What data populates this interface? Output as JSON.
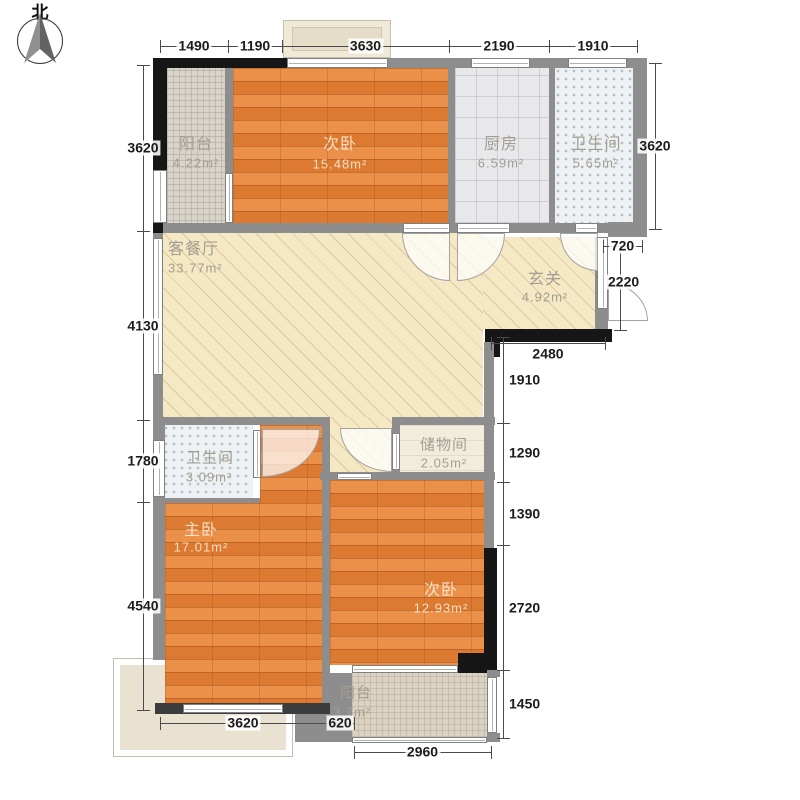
{
  "compass": {
    "north": "北"
  },
  "elements": [
    {
      "n": "patio-terrace",
      "c": "el patio",
      "x": 113,
      "y": 658,
      "w": 180,
      "h": 99
    },
    {
      "n": "bay-window",
      "c": "el bay",
      "x": 283,
      "y": 20,
      "w": 108,
      "h": 38
    },
    {
      "n": "bay-window-inner",
      "c": "el bayin",
      "x": 292,
      "y": 27,
      "w": 90,
      "h": 24
    },
    {
      "n": "balcony-north-floor",
      "c": "el mosaic",
      "x": 167,
      "y": 68,
      "w": 58,
      "h": 165
    },
    {
      "n": "bedroom-north-floor",
      "c": "el wood",
      "x": 233,
      "y": 68,
      "w": 215,
      "h": 155
    },
    {
      "n": "kitchen-floor",
      "c": "el ktile",
      "x": 455,
      "y": 68,
      "w": 94,
      "h": 155
    },
    {
      "n": "bathroom-north-floor",
      "c": "el dots",
      "x": 555,
      "y": 68,
      "w": 78,
      "h": 155
    },
    {
      "n": "living-dining-floor",
      "c": "el hatch",
      "x": 163,
      "y": 233,
      "w": 320,
      "h": 184
    },
    {
      "n": "entry-floor",
      "c": "el hatch",
      "x": 483,
      "y": 237,
      "w": 112,
      "h": 92
    },
    {
      "n": "corridor-floor",
      "c": "el hatch",
      "x": 330,
      "y": 417,
      "w": 62,
      "h": 55
    },
    {
      "n": "storage-floor",
      "c": "el cream",
      "x": 400,
      "y": 425,
      "w": 87,
      "h": 47
    },
    {
      "n": "bathroom-south-floor",
      "c": "el dots",
      "x": 163,
      "y": 425,
      "w": 90,
      "h": 73
    },
    {
      "n": "vestibule-floor",
      "c": "el wood",
      "x": 260,
      "y": 425,
      "w": 62,
      "h": 78
    },
    {
      "n": "master-bedroom-floor",
      "c": "el wood",
      "x": 165,
      "y": 503,
      "w": 157,
      "h": 200
    },
    {
      "n": "bedroom-south-floor",
      "c": "el wood",
      "x": 330,
      "y": 480,
      "w": 154,
      "h": 185
    },
    {
      "n": "balcony-south-floor",
      "c": "el mosaic2",
      "x": 352,
      "y": 673,
      "w": 135,
      "h": 64
    },
    {
      "n": "top-wall-left",
      "c": "el wallb",
      "x": 153,
      "y": 58,
      "w": 134,
      "h": 10
    },
    {
      "n": "top-wall-right",
      "c": "el wall",
      "x": 388,
      "y": 58,
      "w": 259,
      "h": 10
    },
    {
      "n": "left-wall-upper",
      "c": "el wallb",
      "x": 153,
      "y": 68,
      "w": 14,
      "h": 102
    },
    {
      "n": "left-wall-upper-corner",
      "c": "el wallb",
      "x": 153,
      "y": 223,
      "w": 14,
      "h": 10
    },
    {
      "n": "balcony-partition-wall",
      "c": "el wall",
      "x": 225,
      "y": 68,
      "w": 8,
      "h": 105
    },
    {
      "n": "bedroom-kitchen-wall",
      "c": "el wall",
      "x": 448,
      "y": 68,
      "w": 7,
      "h": 155
    },
    {
      "n": "kitchen-bath-wall",
      "c": "el wall",
      "x": 549,
      "y": 68,
      "w": 6,
      "h": 155
    },
    {
      "n": "right-outer-wall",
      "c": "el wall",
      "x": 633,
      "y": 58,
      "w": 14,
      "h": 179
    },
    {
      "n": "band-bottom-wall-a",
      "c": "el wall",
      "x": 163,
      "y": 223,
      "w": 240,
      "h": 10
    },
    {
      "n": "band-bottom-wall-b",
      "c": "el wall",
      "x": 450,
      "y": 223,
      "w": 7,
      "h": 10
    },
    {
      "n": "band-bottom-wall-c",
      "c": "el wall",
      "x": 510,
      "y": 223,
      "w": 65,
      "h": 10
    },
    {
      "n": "band-bottom-wall-d",
      "c": "el wall",
      "x": 598,
      "y": 223,
      "w": 10,
      "h": 10
    },
    {
      "n": "step-wall",
      "c": "el wall",
      "x": 608,
      "y": 222,
      "w": 39,
      "h": 15
    },
    {
      "n": "entry-right-wall",
      "c": "el wall",
      "x": 595,
      "y": 237,
      "w": 13,
      "h": 92
    },
    {
      "n": "entry-black-wall",
      "c": "el wallb",
      "x": 485,
      "y": 329,
      "w": 127,
      "h": 13
    },
    {
      "n": "entry-corner-black",
      "c": "el wallb",
      "x": 487,
      "y": 342,
      "w": 13,
      "h": 15
    },
    {
      "n": "right-mid-wall",
      "c": "el wall",
      "x": 484,
      "y": 342,
      "w": 10,
      "h": 206
    },
    {
      "n": "bedroom-south-right-wall",
      "c": "el wallb",
      "x": 484,
      "y": 548,
      "w": 13,
      "h": 125
    },
    {
      "n": "mid-wall-west",
      "c": "el wall",
      "x": 163,
      "y": 417,
      "w": 167,
      "h": 8
    },
    {
      "n": "mid-wall-east",
      "c": "el wall",
      "x": 392,
      "y": 417,
      "w": 103,
      "h": 8
    },
    {
      "n": "storage-left-wall",
      "c": "el wall",
      "x": 392,
      "y": 425,
      "w": 8,
      "h": 55
    },
    {
      "n": "storage-bottom-wall",
      "c": "el wall",
      "x": 392,
      "y": 472,
      "w": 103,
      "h": 8
    },
    {
      "n": "corridor-bottom-wall",
      "c": "el wall",
      "x": 320,
      "y": 472,
      "w": 72,
      "h": 8
    },
    {
      "n": "vestibule-right-wall",
      "c": "el wall",
      "x": 322,
      "y": 425,
      "w": 8,
      "h": 55
    },
    {
      "n": "bathroom-south-bottom-wall",
      "c": "el wall",
      "x": 163,
      "y": 498,
      "w": 97,
      "h": 5
    },
    {
      "n": "bedroom-divider-wall",
      "c": "el wall",
      "x": 322,
      "y": 480,
      "w": 8,
      "h": 223
    },
    {
      "n": "balcony-south-left-wall",
      "c": "el wall",
      "x": 330,
      "y": 673,
      "w": 22,
      "h": 69
    },
    {
      "n": "master-bottom-side-wall",
      "c": "el wall",
      "x": 295,
      "y": 703,
      "w": 35,
      "h": 39
    },
    {
      "n": "master-bottom-wall",
      "c": "el walld",
      "x": 155,
      "y": 703,
      "w": 175,
      "h": 11
    },
    {
      "n": "balcony-corner-black",
      "c": "el wallb",
      "x": 458,
      "y": 653,
      "w": 39,
      "h": 20
    },
    {
      "n": "balcony-corner-sq1",
      "c": "el wall",
      "x": 487,
      "y": 670,
      "w": 13,
      "h": 7
    },
    {
      "n": "balcony-corner-sq2",
      "c": "el wall",
      "x": 487,
      "y": 733,
      "w": 13,
      "h": 9
    },
    {
      "n": "left-wall-mid",
      "c": "el wall",
      "x": 153,
      "y": 233,
      "w": 10,
      "h": 187
    },
    {
      "n": "left-wall-low1",
      "c": "el wall",
      "x": 153,
      "y": 420,
      "w": 12,
      "h": 80
    },
    {
      "n": "left-wall-low2",
      "c": "el wall",
      "x": 153,
      "y": 500,
      "w": 12,
      "h": 160
    },
    {
      "n": "bay-base-window",
      "c": "el win wh",
      "x": 287,
      "y": 58,
      "w": 101,
      "h": 10
    },
    {
      "n": "balcony-left-window",
      "c": "el win wv",
      "x": 153,
      "y": 170,
      "w": 14,
      "h": 53
    },
    {
      "n": "partition-window",
      "c": "el win wv",
      "x": 225,
      "y": 173,
      "w": 8,
      "h": 50
    },
    {
      "n": "kitchen-top-window",
      "c": "el win wh",
      "x": 471,
      "y": 58,
      "w": 59,
      "h": 10
    },
    {
      "n": "bath-north-top-window",
      "c": "el win wh",
      "x": 568,
      "y": 58,
      "w": 59,
      "h": 10
    },
    {
      "n": "living-left-window",
      "c": "el win wv",
      "x": 153,
      "y": 238,
      "w": 10,
      "h": 137
    },
    {
      "n": "bath-south-left-window",
      "c": "el win wv",
      "x": 153,
      "y": 440,
      "w": 12,
      "h": 57
    },
    {
      "n": "entry-right-window",
      "c": "el win wv",
      "x": 597,
      "y": 237,
      "w": 11,
      "h": 72
    },
    {
      "n": "bedroom-balcony-window",
      "c": "el win wh",
      "x": 352,
      "y": 665,
      "w": 106,
      "h": 8
    },
    {
      "n": "balcony-right-rail",
      "c": "el win wv",
      "x": 487,
      "y": 677,
      "w": 10,
      "h": 56
    },
    {
      "n": "balcony-bottom-rail",
      "c": "el win wh",
      "x": 352,
      "y": 737,
      "w": 135,
      "h": 6
    },
    {
      "n": "master-bottom-window",
      "c": "el win wh",
      "x": 183,
      "y": 704,
      "w": 100,
      "h": 9
    },
    {
      "n": "storage-door-jamb",
      "c": "el win wv",
      "x": 392,
      "y": 433,
      "w": 8,
      "h": 37
    },
    {
      "n": "bath-south-door-jamb",
      "c": "el win wv",
      "x": 253,
      "y": 430,
      "w": 8,
      "h": 48
    },
    {
      "n": "corridor-bedroom-opening",
      "c": "el win wh",
      "x": 337,
      "y": 473,
      "w": 35,
      "h": 7
    },
    {
      "n": "bedroom-north-door-opening",
      "c": "el win wh",
      "x": 403,
      "y": 223,
      "w": 47,
      "h": 10
    },
    {
      "n": "kitchen-door-opening",
      "c": "el win wh",
      "x": 457,
      "y": 223,
      "w": 53,
      "h": 10
    },
    {
      "n": "bath-north-door-opening",
      "c": "el win wh",
      "x": 575,
      "y": 223,
      "w": 23,
      "h": 10
    },
    {
      "n": "bedroom-north-door",
      "c": "el door c-bl",
      "x": 402,
      "y": 233,
      "w": 48,
      "h": 48
    },
    {
      "n": "kitchen-door",
      "c": "el door c-br",
      "x": 457,
      "y": 233,
      "w": 48,
      "h": 48
    },
    {
      "n": "bath-north-door",
      "c": "el door c-bl",
      "x": 560,
      "y": 233,
      "w": 38,
      "h": 38
    },
    {
      "n": "entry-door",
      "c": "el door c-tr",
      "x": 608,
      "y": 283,
      "w": 40,
      "h": 38
    },
    {
      "n": "bath-south-door",
      "c": "el door c-br",
      "x": 262,
      "y": 429,
      "w": 58,
      "h": 48
    },
    {
      "n": "storage-door",
      "c": "el door c-bl",
      "x": 340,
      "y": 428,
      "w": 52,
      "h": 44
    }
  ],
  "dims": [
    {
      "o": "h",
      "x": 160,
      "y": 46,
      "l": 68,
      "t": "1490"
    },
    {
      "o": "h",
      "x": 228,
      "y": 46,
      "l": 54,
      "t": "1190"
    },
    {
      "o": "h",
      "x": 282,
      "y": 46,
      "l": 167,
      "t": "3630"
    },
    {
      "o": "h",
      "x": 449,
      "y": 46,
      "l": 100,
      "t": "2190"
    },
    {
      "o": "h",
      "x": 549,
      "y": 46,
      "l": 88,
      "t": "1910"
    },
    {
      "o": "v",
      "x": 143,
      "y": 65,
      "l": 166,
      "t": "3620"
    },
    {
      "o": "v",
      "x": 143,
      "y": 231,
      "l": 189,
      "t": "4130"
    },
    {
      "o": "v",
      "x": 143,
      "y": 420,
      "l": 82,
      "t": "1780"
    },
    {
      "o": "v",
      "x": 143,
      "y": 502,
      "l": 208,
      "t": "4540"
    },
    {
      "o": "v",
      "x": 655,
      "y": 63,
      "l": 166,
      "t": "3620"
    },
    {
      "o": "h",
      "x": 603,
      "y": 246,
      "l": 39,
      "t": "720"
    },
    {
      "o": "v",
      "x": 620,
      "y": 246,
      "l": 84,
      "t": "2220",
      "la": "l",
      "lx": 606,
      "ly": 282
    },
    {
      "o": "h",
      "x": 491,
      "y": 343,
      "l": 114,
      "t": "2480",
      "ly": 354
    },
    {
      "o": "v",
      "x": 503,
      "y": 337,
      "l": 86,
      "t": "1910",
      "la": "l",
      "lx": 507
    },
    {
      "o": "v",
      "x": 503,
      "y": 423,
      "l": 59,
      "t": "1290",
      "la": "l",
      "lx": 507
    },
    {
      "o": "v",
      "x": 503,
      "y": 482,
      "l": 63,
      "t": "1390",
      "la": "l",
      "lx": 507
    },
    {
      "o": "v",
      "x": 503,
      "y": 545,
      "l": 125,
      "t": "2720",
      "la": "l",
      "lx": 507
    },
    {
      "o": "v",
      "x": 503,
      "y": 670,
      "l": 68,
      "t": "1450",
      "la": "l",
      "lx": 507
    },
    {
      "o": "h",
      "x": 160,
      "y": 723,
      "l": 166,
      "t": "3620"
    },
    {
      "o": "h",
      "x": 326,
      "y": 723,
      "l": 28,
      "t": "620"
    },
    {
      "o": "h",
      "x": 354,
      "y": 752,
      "l": 137,
      "t": "2960"
    }
  ],
  "labels": [
    {
      "n": "room-label-balcony-north",
      "t": "阳台",
      "x": 196,
      "y": 142,
      "f": 16,
      "c": "lt"
    },
    {
      "n": "room-area-balcony-north",
      "t": "4.22m²",
      "x": 196,
      "y": 163,
      "f": 13,
      "c": "lt"
    },
    {
      "n": "room-label-bedroom-north",
      "t": "次卧",
      "x": 340,
      "y": 142,
      "f": 16,
      "c": "wd"
    },
    {
      "n": "room-area-bedroom-north",
      "t": "15.48m²",
      "x": 340,
      "y": 164,
      "f": 13,
      "c": "wd"
    },
    {
      "n": "room-label-kitchen",
      "t": "厨房",
      "x": 501,
      "y": 142,
      "f": 16,
      "c": "lt"
    },
    {
      "n": "room-area-kitchen",
      "t": "6.59m²",
      "x": 501,
      "y": 163,
      "f": 13,
      "c": "lt"
    },
    {
      "n": "room-label-bathroom-north",
      "t": "卫生间",
      "x": 596,
      "y": 142,
      "f": 16,
      "c": "lt"
    },
    {
      "n": "room-area-bathroom-north",
      "t": "5.65m²",
      "x": 596,
      "y": 163,
      "f": 13,
      "c": "lt"
    },
    {
      "n": "room-label-living-dining",
      "t": "客餐厅",
      "x": 168,
      "y": 247,
      "f": 16,
      "c": "lt",
      "la": "l"
    },
    {
      "n": "room-area-living-dining",
      "t": "33.77m²",
      "x": 168,
      "y": 268,
      "f": 13,
      "c": "lt",
      "la": "l"
    },
    {
      "n": "room-label-entry",
      "t": "玄关",
      "x": 545,
      "y": 277,
      "f": 16,
      "c": "lt"
    },
    {
      "n": "room-area-entry",
      "t": "4.92m²",
      "x": 545,
      "y": 297,
      "f": 13,
      "c": "lt"
    },
    {
      "n": "room-label-storage",
      "t": "储物间",
      "x": 444,
      "y": 444,
      "f": 15,
      "c": "lt"
    },
    {
      "n": "room-area-storage",
      "t": "2.05m²",
      "x": 444,
      "y": 463,
      "f": 13,
      "c": "lt"
    },
    {
      "n": "room-label-bathroom-south",
      "t": "卫生间",
      "x": 210,
      "y": 457,
      "f": 15,
      "c": "lt"
    },
    {
      "n": "room-area-bathroom-south",
      "t": "3.09m²",
      "x": 209,
      "y": 477,
      "f": 13,
      "c": "lt"
    },
    {
      "n": "room-label-master-bedroom",
      "t": "主卧",
      "x": 201,
      "y": 528,
      "f": 16,
      "c": "wd"
    },
    {
      "n": "room-area-master-bedroom",
      "t": "17.01m²",
      "x": 201,
      "y": 547,
      "f": 13,
      "c": "wd"
    },
    {
      "n": "room-label-bedroom-south",
      "t": "次卧",
      "x": 441,
      "y": 588,
      "f": 16,
      "c": "wd"
    },
    {
      "n": "room-area-bedroom-south",
      "t": "12.93m²",
      "x": 441,
      "y": 608,
      "f": 13,
      "c": "wd"
    },
    {
      "n": "room-label-balcony-south",
      "t": "阳台",
      "x": 356,
      "y": 692,
      "f": 15,
      "c": "lt"
    },
    {
      "n": "room-area-balcony-south",
      "t": "3.7m²",
      "x": 352,
      "y": 712,
      "f": 13,
      "c": "lt"
    }
  ]
}
